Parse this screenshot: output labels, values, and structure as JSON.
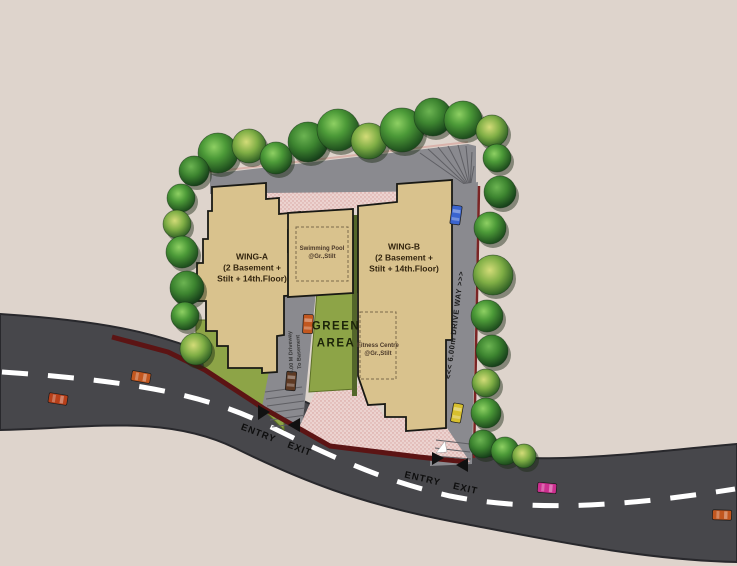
{
  "title": "Residential site layout plan",
  "labels": {
    "wing_a": "WING-A\n(2 Basement +\nStilt + 14th.Floor)",
    "wing_b": "WING-B\n(2 Basement +\nStilt + 14th.Floor)",
    "swimming_pool": "Swimming Pool\n@Gr.,Stilt",
    "fitness_centre": "Fitness Centre\n@Gr.,Stilt",
    "green_area": "GREEN\nAREA",
    "driveway_basement": "6.00 M Driveway\nTo Basement",
    "drive_way": "<<< 6.00m DRIVE WAY >>>",
    "entry": "ENTRY",
    "exit": "EXIT"
  },
  "colors": {
    "background": "#ded4cc",
    "road": "#47474b",
    "road_outline": "#28282c",
    "road_marking": "#ffffff",
    "driveway": "#8a8a8f",
    "building": "#d9c28d",
    "building_outline": "#191914",
    "plaza": "#ecd3d0",
    "plaza_dot": "#d49b97",
    "green_area": "#8da447",
    "green_dark": "#53662a",
    "wall": "#5c1414",
    "tree_foliage": "#4f9c3c",
    "cars": {
      "blue": "#3a64cf",
      "yellow": "#d8c02e",
      "orange": "#c2571f",
      "red": "#b8401a",
      "magenta": "#cc2f8f",
      "brown": "#5e3a24"
    }
  }
}
